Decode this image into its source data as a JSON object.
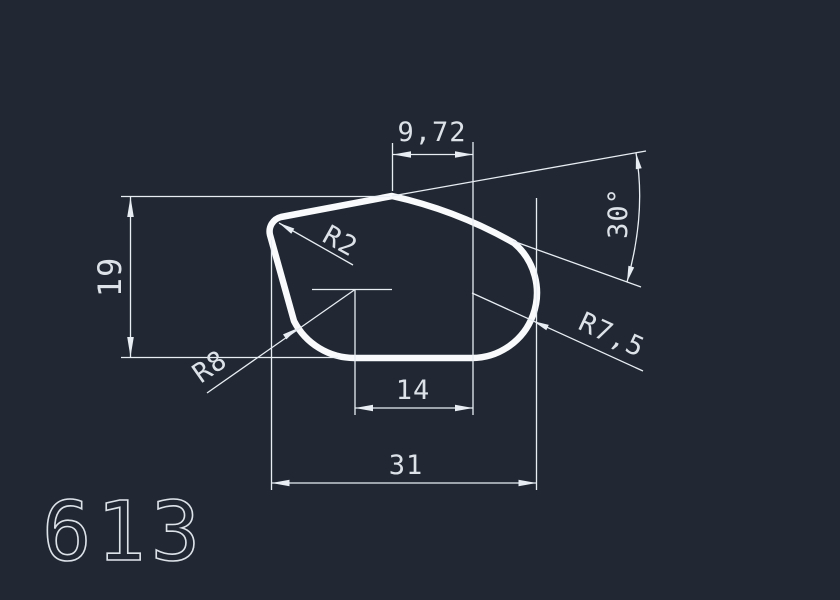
{
  "drawing": {
    "part_number": "613",
    "colors": {
      "bg": "#212833",
      "line": "#e8edf3",
      "outline": "#f8fafc",
      "text": "#dde2e9"
    },
    "labels": {
      "width_top": "9,72",
      "height_left": "19",
      "width_mid": "14",
      "width_total": "31",
      "angle": "30°",
      "radius_corner": "R2",
      "radius_bottom": "R8",
      "radius_right": "R7,5"
    }
  }
}
